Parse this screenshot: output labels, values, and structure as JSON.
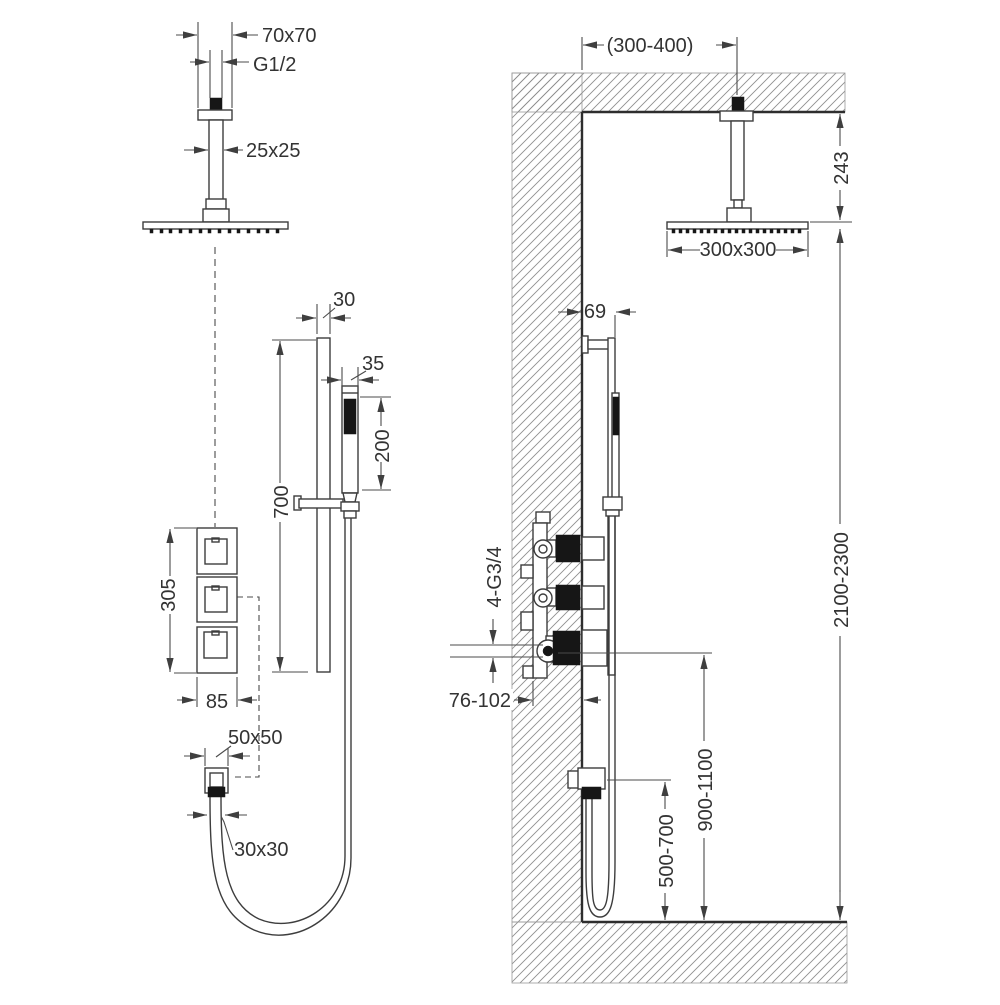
{
  "views": {
    "front": {
      "labels": {
        "ceiling_flange": "70x70",
        "thread": "G1/2",
        "arm_section": "25x25",
        "rail_width": "30",
        "hand_shower_width": "35",
        "hand_shower_length": "200",
        "rail_length": "700",
        "valve_group_height": "305",
        "valve_group_width": "85",
        "outlet_flange": "50x50",
        "outlet_connection": "30x30"
      }
    },
    "side": {
      "labels": {
        "arm_wall_distance": "(300-400)",
        "head_ceiling_distance": "243",
        "head_size": "300x300",
        "rail_wall_distance": "69",
        "pipe_connections": "4-G3/4",
        "recess_depth": "76-102",
        "installation_height": "2100-2300",
        "valve_floor_height": "900-1100",
        "outlet_floor_height": "500-700"
      }
    }
  },
  "colors": {
    "line": "#3d3d3d",
    "dimension_line": "#4b4b4b",
    "dark_fill": "#161616",
    "hatch": "#8f8f8f",
    "text": "#333333",
    "background": "#ffffff"
  }
}
